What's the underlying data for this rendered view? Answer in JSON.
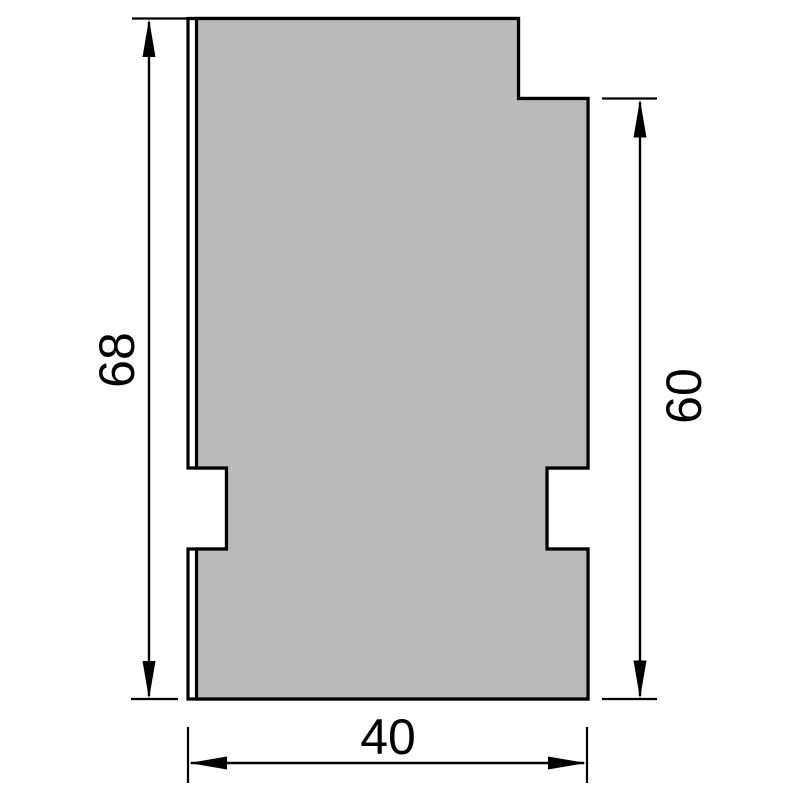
{
  "drawing": {
    "type": "technical-cross-section-profile",
    "background_color": "#ffffff",
    "outline_color": "#000000",
    "fill_color": "#bababa",
    "profile": {
      "outer_contour_points": "188,18.5 518.5,18.5 518.5,98.5 588,98.5 588,468 547,468 547,549 588,549 588,699 188,699 188,549 226.5,549 226.5,468 188,468",
      "body_points": "196.5,18.5 518.5,18.5 518.5,98.5 588,98.5 588,468 547,468 547,549 588,549 588,699 196.5,699 196.5,549 226.5,549 226.5,468 196.5,468"
    },
    "dimensions": {
      "left_height": {
        "label": "68",
        "orientation": "vertical"
      },
      "right_height": {
        "label": "60",
        "orientation": "vertical"
      },
      "bottom_width": {
        "label": "40",
        "orientation": "horizontal"
      }
    }
  }
}
